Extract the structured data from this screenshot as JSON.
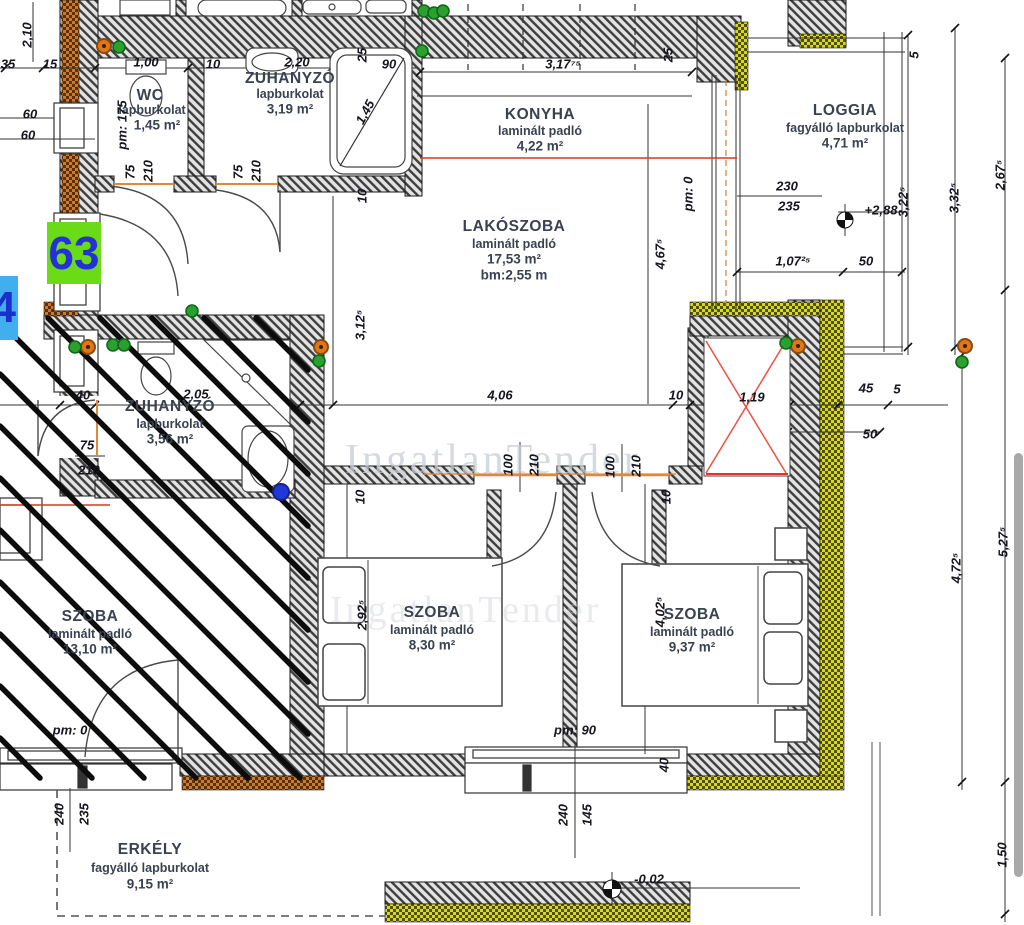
{
  "badges": {
    "unit": "63",
    "neighbor": "4"
  },
  "watermark": {
    "text": "IngatlanTender"
  },
  "levels": {
    "upper": "+2,88",
    "lower": "-0,02"
  },
  "rooms": {
    "wc": {
      "name": "WC",
      "finish": "lapburkolat",
      "area": "1,45 m²"
    },
    "zuhanyzo1": {
      "name": "ZUHANYZÓ",
      "finish": "lapburkolat",
      "area": "3,19 m²"
    },
    "konyha": {
      "name": "KONYHA",
      "finish": "laminált padló",
      "area": "4,22 m²"
    },
    "lakoszoba": {
      "name": "LAKÓSZOBA",
      "finish": "laminált padló",
      "area": "17,53 m²",
      "extra": "bm:2,55 m"
    },
    "loggia": {
      "name": "LOGGIA",
      "finish": "fagyálló lapburkolat",
      "area": "4,71 m²"
    },
    "zuhanyzo2": {
      "name": "ZUHANYZÓ",
      "finish": "lapburkolat",
      "area": "3,56 m²"
    },
    "szoba1": {
      "name": "SZOBA",
      "finish": "laminált padló",
      "area": "13,10 m²"
    },
    "szoba2": {
      "name": "SZOBA",
      "finish": "laminált padló",
      "area": "8,30 m²"
    },
    "szoba3": {
      "name": "SZOBA",
      "finish": "laminált padló",
      "area": "9,37 m²"
    },
    "erkely": {
      "name": "ERKÉLY",
      "finish": "fagyálló lapburkolat",
      "area": "9,15 m²"
    }
  },
  "dims": [
    "2,10",
    "35",
    "15",
    "1,00",
    "10",
    "2,20",
    "90",
    "25",
    "3,17⁷⁵",
    "25",
    "5",
    "60",
    "60",
    "pm: 175",
    "75",
    "210",
    "75",
    "210",
    "1,45",
    "10",
    "pm: 0",
    "4,67⁵",
    "3,12⁵",
    "230",
    "235",
    "1,07²⁵",
    "50",
    "3,22⁵",
    "3,32⁵",
    "2,67⁵",
    "40",
    "2,05",
    "4,06",
    "10",
    "1,19",
    "45",
    "5",
    "50",
    "75",
    "210",
    "100",
    "210",
    "100",
    "210",
    "10",
    "10",
    "2,92⁵",
    "4,02⁵",
    "4,72⁵",
    "5,27⁵",
    "pm: 0",
    "pm: 90",
    "40",
    "240",
    "235",
    "240",
    "145",
    "1,50"
  ]
}
